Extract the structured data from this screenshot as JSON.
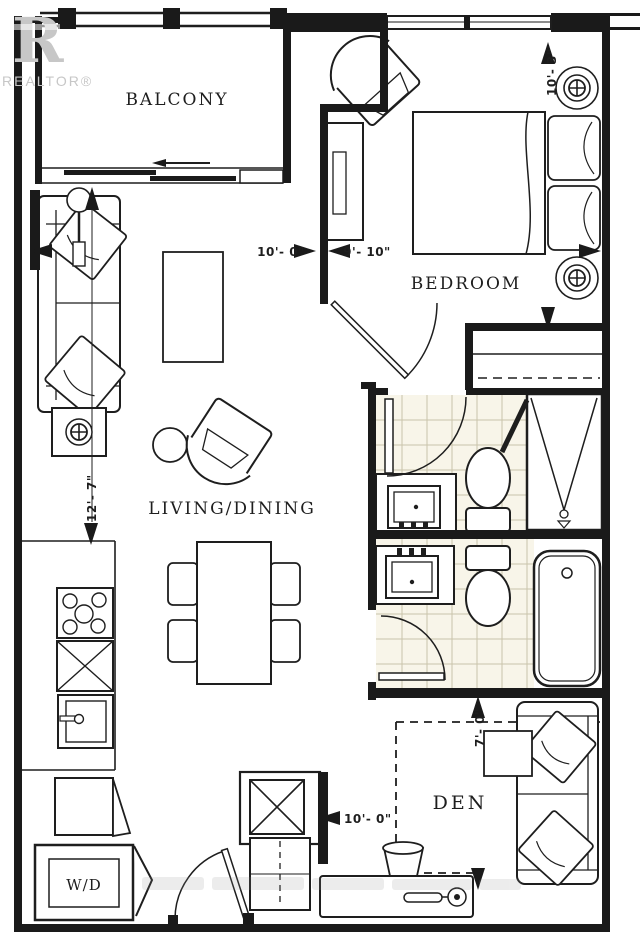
{
  "branding": {
    "logo_letter": "R",
    "wordmark": "REALTOR®"
  },
  "rooms": {
    "balcony": "BALCONY",
    "bedroom": "BEDROOM",
    "living_dining": "LIVING/DINING",
    "den": "DEN",
    "laundry": "W/D"
  },
  "dimensions": {
    "living_width": "10'- 0\"",
    "living_depth": "12'- 7\"",
    "bedroom_width": "9'- 10\"",
    "bedroom_depth": "10'- 3\"",
    "den_depth": "7'- 0\"",
    "entry_width": "10'- 0\""
  },
  "colors": {
    "ink": "#1a1a1a",
    "tile_bg": "#f8f5e9",
    "tile_line": "#c9c4ab",
    "watermark_grey": "#c7c7c7"
  }
}
